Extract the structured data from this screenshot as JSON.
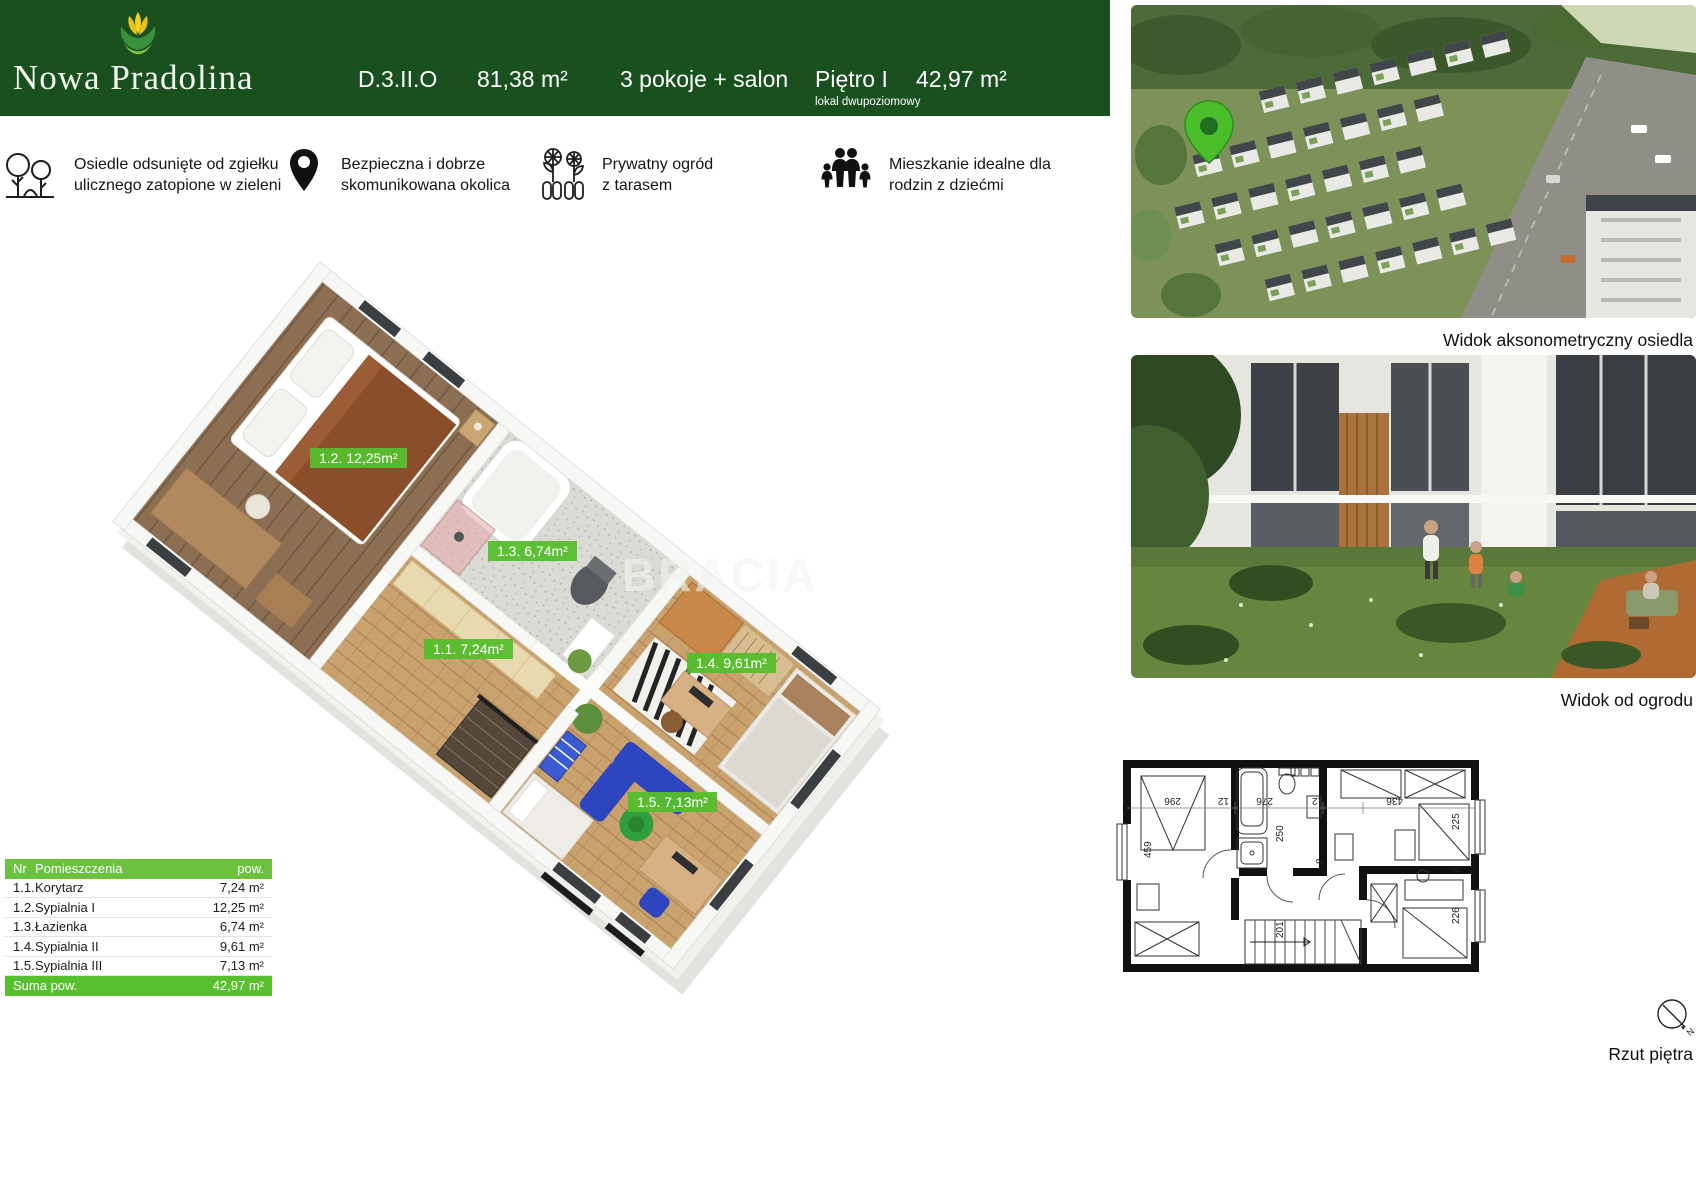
{
  "header": {
    "brand": "Nowa Pradolina",
    "unit_code": "D.3.II.O",
    "total_area": "81,38 m²",
    "rooms_summary": "3 pokoje + salon",
    "floor": "Piętro I",
    "floor_note": "lokal dwupoziomowy",
    "floor_area": "42,97 m²"
  },
  "features": [
    {
      "icon": "trees-icon",
      "line1": "Osiedle odsunięte od zgiełku",
      "line2": "ulicznego zatopione  w zieleni"
    },
    {
      "icon": "location-pin-icon",
      "line1": "Bezpieczna i dobrze",
      "line2": "skomunikowana okolica"
    },
    {
      "icon": "garden-icon",
      "line1": "Prywatny ogród",
      "line2": "z tarasem"
    },
    {
      "icon": "family-icon",
      "line1": "Mieszkanie idealne dla",
      "line2": "rodzin z dziećmi"
    }
  ],
  "plan3d": {
    "watermark": "BRACIA",
    "labels": [
      {
        "room": "1.2",
        "text": "1.2. 12,25m²"
      },
      {
        "room": "1.3",
        "text": "1.3. 6,74m²"
      },
      {
        "room": "1.1",
        "text": "1.1. 7,24m²"
      },
      {
        "room": "1.4",
        "text": "1.4. 9,61m²"
      },
      {
        "room": "1.5",
        "text": "1.5. 7,13m²"
      }
    ]
  },
  "rooms_table": {
    "header": {
      "nr": "Nr",
      "name": "Pomieszczenia",
      "area": "pow."
    },
    "rows": [
      {
        "nr": "1.1.",
        "name": "Korytarz",
        "area": "7,24 m²"
      },
      {
        "nr": "1.2.",
        "name": "Sypialnia I",
        "area": "12,25 m²"
      },
      {
        "nr": "1.3.",
        "name": "Łazienka",
        "area": "6,74 m²"
      },
      {
        "nr": "1.4.",
        "name": "Sypialnia II",
        "area": "9,61 m²"
      },
      {
        "nr": "1.5.",
        "name": "Sypialnia III",
        "area": "7,13 m²"
      }
    ],
    "total": {
      "label": "Suma pow.",
      "value": "42,97 m²"
    }
  },
  "captions": {
    "aerial": "Widok aksonometryczny osiedla",
    "garden": "Widok od ogrodu",
    "tech_plan": "Rzut piętra"
  },
  "tech_plan": {
    "dims": {
      "d296": "296",
      "d459": "459",
      "d12a": "12",
      "d276": "276",
      "d250": "250",
      "d12b": "12",
      "d436": "436",
      "d225": "225",
      "d8a": "8",
      "d226": "226",
      "d201": "201",
      "d8b": "8"
    },
    "north": "N"
  },
  "colors": {
    "header_green": "#1a5020",
    "accent_green": "#57bf2e",
    "table_header_green": "#6cc13f",
    "total_row_green": "#58c02e",
    "pin_green": "#4abd2b"
  }
}
